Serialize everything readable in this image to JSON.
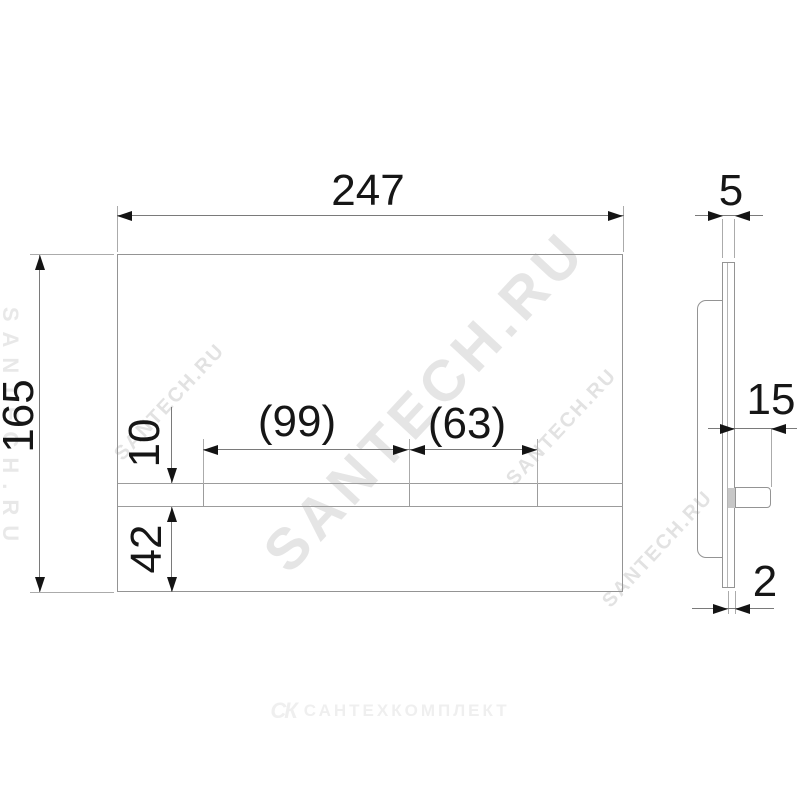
{
  "drawing": {
    "front_view": {
      "width": "247",
      "height": "165",
      "button_large": "(99)",
      "button_small": "(63)",
      "strip_height": "10",
      "strip_bottom_offset": "42"
    },
    "side_view": {
      "plate_thickness": "5",
      "button_depth": "15",
      "panel_thickness": "2"
    }
  },
  "watermarks": {
    "main": "SANTECH.RU",
    "small_left": "SANTECH.RU",
    "small_right": "SANTECH.RU",
    "small_far_right": "SANTECH.RU",
    "edge": "SANTECH.RU",
    "logo_monogram": "СК",
    "logo_text": "САНТЕХКОМПЛЕКТ"
  },
  "colors": {
    "outline": "#949494",
    "dimension_line": "#7a7a7a",
    "arrow_and_text": "#141414",
    "watermark": "#d6d6d6",
    "logo": "#efefef"
  }
}
